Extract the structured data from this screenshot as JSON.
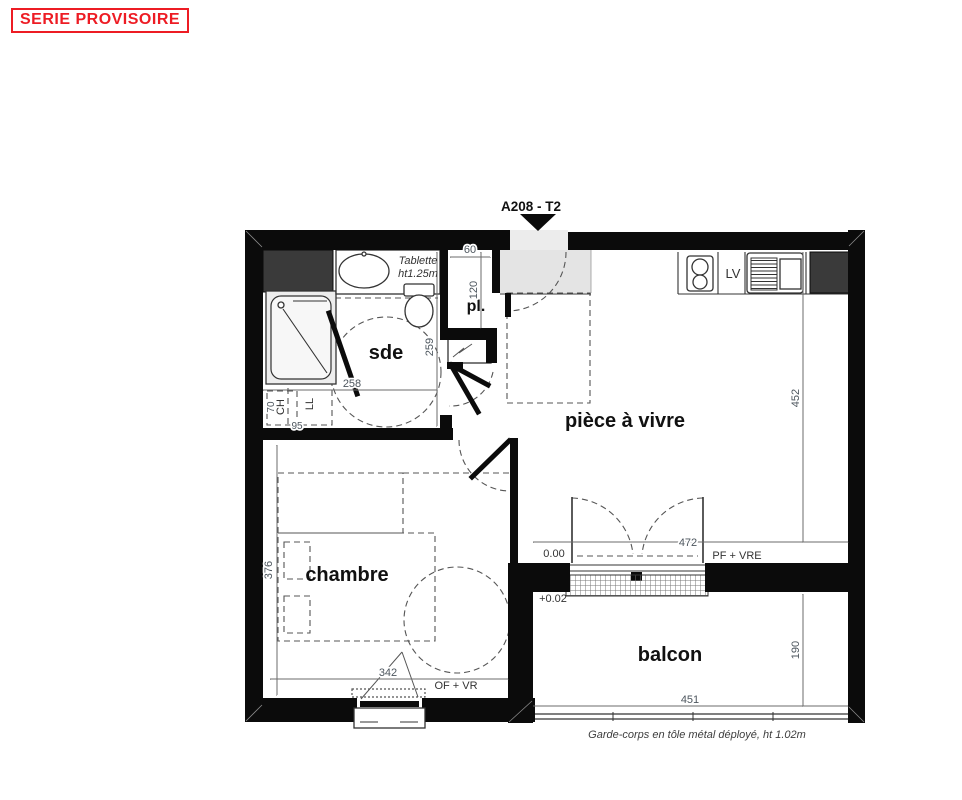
{
  "stamp": {
    "text": "SERIE PROVISOIRE"
  },
  "plan": {
    "unit_label": "A208 - T2",
    "rooms": {
      "sde": "sde",
      "placard": "pl.",
      "living": "pièce à vivre",
      "bedroom": "chambre",
      "balcony": "balcon"
    },
    "fixtures": {
      "shelf_line1": "Tablette",
      "shelf_line2": "ht1.25m",
      "washing_machine": "LL",
      "water_heater": "CH",
      "dishwasher": "LV"
    },
    "levels": {
      "living": "0.00",
      "balcony": "+0.02"
    },
    "openings": {
      "balcony_door": "PF + VRE",
      "bedroom_window": "OF + VR"
    },
    "dimensions": {
      "d60": "60",
      "d120": "120",
      "d259": "259",
      "d258": "258",
      "d70": "70",
      "d95": "95",
      "d452": "452",
      "d472": "472",
      "d376": "376",
      "d342": "342",
      "d190": "190",
      "d451": "451"
    },
    "note": "Garde-corps en tôle métal déployé, ht 1.02m"
  },
  "colors": {
    "stamp_red": "#ed1c24",
    "wall_black": "#0b0b0b",
    "duct_gray": "#3a3a3a",
    "entry_gray": "#e4e4e4"
  }
}
